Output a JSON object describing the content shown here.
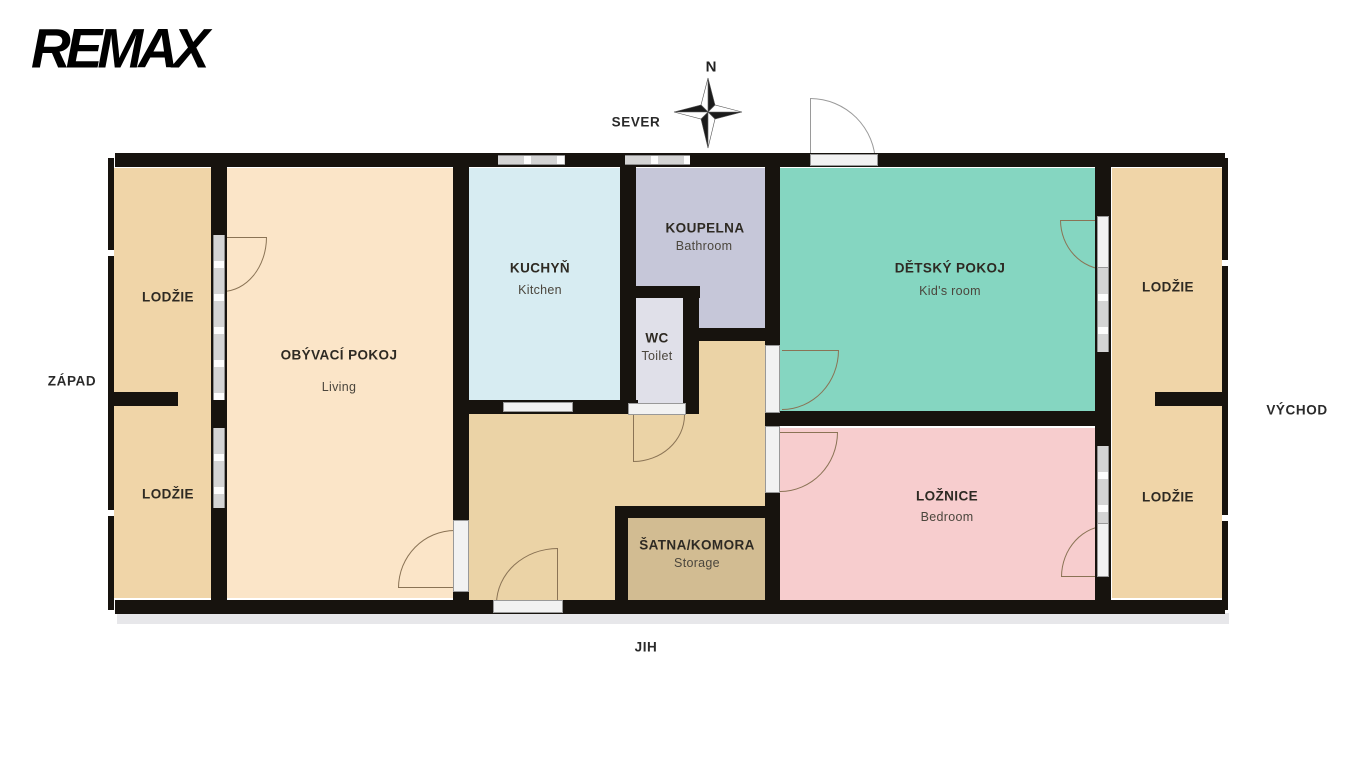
{
  "brand": {
    "logo_text": "REMAX"
  },
  "compass": {
    "north_letter": "N"
  },
  "directions": {
    "north": "SEVER",
    "south": "JIH",
    "west": "ZÁPAD",
    "east": "VÝCHOD"
  },
  "rooms": {
    "living": {
      "name": "OBÝVACÍ POKOJ",
      "name_en": "Living",
      "color": "#fbe5c8"
    },
    "kitchen": {
      "name": "KUCHYŇ",
      "name_en": "Kitchen",
      "color": "#d7ecf2"
    },
    "bathroom": {
      "name": "KOUPELNA",
      "name_en": "Bathroom",
      "color": "#c6c7d9"
    },
    "wc": {
      "name": "WC",
      "name_en": "Toilet",
      "color": "#e0e0e9"
    },
    "kids_room": {
      "name": "DĚTSKÝ POKOJ",
      "name_en": "Kid's room",
      "color": "#85d6c1"
    },
    "bedroom": {
      "name": "LOŽNICE",
      "name_en": "Bedroom",
      "color": "#f7cdce"
    },
    "storage": {
      "name": "ŠATNA/KOMORA",
      "name_en": "Storage",
      "color": "#d2bc92"
    },
    "loggia": {
      "name": "LODŽIE",
      "color": "#f0d5a8"
    },
    "hallway": {
      "color": "#ebd3a6"
    }
  },
  "wall_color": "#17130e"
}
